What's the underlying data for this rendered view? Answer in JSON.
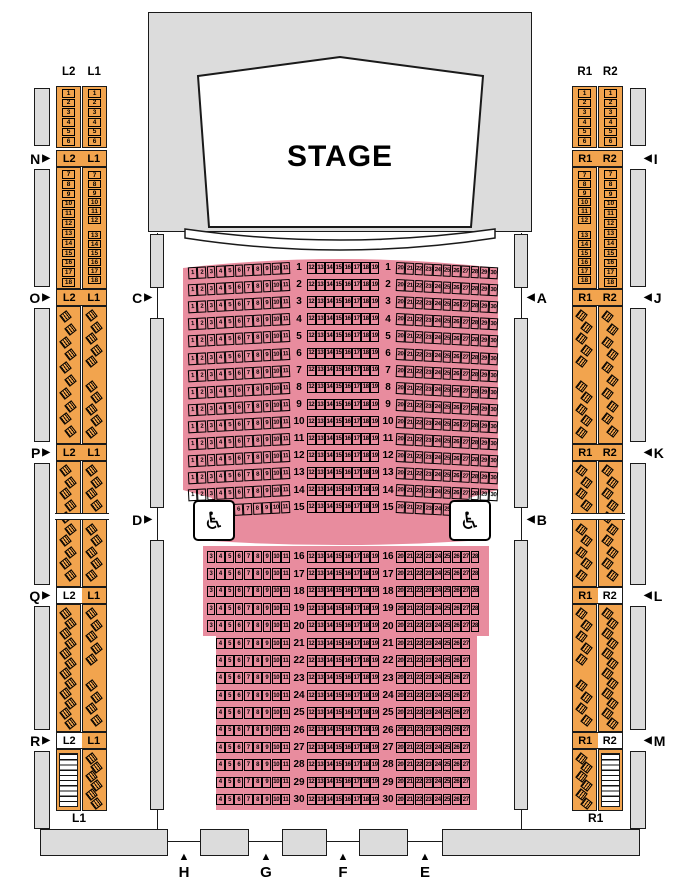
{
  "stage": {
    "label": "STAGE"
  },
  "colors": {
    "box_fill": "#f2a44e",
    "orchestra_fill": "#e88c9e",
    "wall_fill": "#dcdcdc",
    "line": "#1a1a1a",
    "background": "#ffffff"
  },
  "orchestra": {
    "wheelchair_symbol": "♿",
    "rows": [
      {
        "row": 1,
        "left": [
          1,
          11
        ],
        "center": [
          12,
          19
        ],
        "right": [
          20,
          30
        ]
      },
      {
        "row": 2,
        "left": [
          1,
          11
        ],
        "center": [
          12,
          19
        ],
        "right": [
          20,
          30
        ]
      },
      {
        "row": 3,
        "left": [
          1,
          11
        ],
        "center": [
          12,
          19
        ],
        "right": [
          20,
          30
        ]
      },
      {
        "row": 4,
        "left": [
          1,
          11
        ],
        "center": [
          12,
          19
        ],
        "right": [
          20,
          30
        ]
      },
      {
        "row": 5,
        "left": [
          1,
          11
        ],
        "center": [
          12,
          19
        ],
        "right": [
          20,
          30
        ]
      },
      {
        "row": 6,
        "left": [
          1,
          11
        ],
        "center": [
          12,
          19
        ],
        "right": [
          20,
          30
        ]
      },
      {
        "row": 7,
        "left": [
          1,
          11
        ],
        "center": [
          12,
          19
        ],
        "right": [
          20,
          30
        ]
      },
      {
        "row": 8,
        "left": [
          1,
          11
        ],
        "center": [
          12,
          19
        ],
        "right": [
          20,
          30
        ]
      },
      {
        "row": 9,
        "left": [
          1,
          11
        ],
        "center": [
          12,
          19
        ],
        "right": [
          20,
          30
        ]
      },
      {
        "row": 10,
        "left": [
          1,
          11
        ],
        "center": [
          12,
          19
        ],
        "right": [
          20,
          30
        ]
      },
      {
        "row": 11,
        "left": [
          1,
          11
        ],
        "center": [
          12,
          19
        ],
        "right": [
          20,
          30
        ]
      },
      {
        "row": 12,
        "left": [
          1,
          11
        ],
        "center": [
          12,
          19
        ],
        "right": [
          20,
          30
        ]
      },
      {
        "row": 13,
        "left": [
          1,
          11
        ],
        "center": [
          12,
          19
        ],
        "right": [
          20,
          30
        ]
      },
      {
        "row": 14,
        "left": [
          1,
          11
        ],
        "center": [
          12,
          19
        ],
        "right": [
          20,
          30
        ]
      },
      {
        "row": 15,
        "left": [
          6,
          11
        ],
        "center": [
          12,
          19
        ],
        "right": [
          20,
          25
        ]
      },
      {
        "row": 16,
        "left": [
          3,
          11
        ],
        "center": [
          12,
          19
        ],
        "right": [
          20,
          28
        ]
      },
      {
        "row": 17,
        "left": [
          3,
          11
        ],
        "center": [
          12,
          19
        ],
        "right": [
          20,
          28
        ]
      },
      {
        "row": 18,
        "left": [
          3,
          11
        ],
        "center": [
          12,
          19
        ],
        "right": [
          20,
          28
        ]
      },
      {
        "row": 19,
        "left": [
          3,
          11
        ],
        "center": [
          12,
          19
        ],
        "right": [
          20,
          28
        ]
      },
      {
        "row": 20,
        "left": [
          3,
          11
        ],
        "center": [
          12,
          19
        ],
        "right": [
          20,
          28
        ]
      },
      {
        "row": 21,
        "left": [
          4,
          11
        ],
        "center": [
          12,
          19
        ],
        "right": [
          20,
          27
        ]
      },
      {
        "row": 22,
        "left": [
          4,
          11
        ],
        "center": [
          12,
          19
        ],
        "right": [
          20,
          27
        ]
      },
      {
        "row": 23,
        "left": [
          4,
          11
        ],
        "center": [
          12,
          19
        ],
        "right": [
          20,
          27
        ]
      },
      {
        "row": 24,
        "left": [
          4,
          11
        ],
        "center": [
          12,
          19
        ],
        "right": [
          20,
          27
        ]
      },
      {
        "row": 25,
        "left": [
          4,
          11
        ],
        "center": [
          12,
          19
        ],
        "right": [
          20,
          27
        ]
      },
      {
        "row": 26,
        "left": [
          4,
          11
        ],
        "center": [
          12,
          19
        ],
        "right": [
          20,
          27
        ]
      },
      {
        "row": 27,
        "left": [
          4,
          11
        ],
        "center": [
          12,
          19
        ],
        "right": [
          20,
          27
        ]
      },
      {
        "row": 28,
        "left": [
          4,
          11
        ],
        "center": [
          12,
          19
        ],
        "right": [
          20,
          27
        ]
      },
      {
        "row": 29,
        "left": [
          4,
          11
        ],
        "center": [
          12,
          19
        ],
        "right": [
          20,
          27
        ]
      },
      {
        "row": 30,
        "left": [
          4,
          11
        ],
        "center": [
          12,
          19
        ],
        "right": [
          20,
          27
        ]
      }
    ]
  },
  "side_boxes": {
    "left": {
      "column_titles": [
        "L2",
        "L1"
      ],
      "bottom_label": "L1",
      "sections": [
        {
          "marker": null,
          "band_labels": null,
          "cols": [
            {
              "label": "L2",
              "type": "seats",
              "groups": [
                [
                  1,
                  6
                ]
              ]
            },
            {
              "label": "L1",
              "type": "seats",
              "groups": [
                [
                  1,
                  6
                ]
              ]
            }
          ]
        },
        {
          "marker": "N",
          "band_labels": [
            "L2",
            "L1"
          ],
          "cols": [
            {
              "label": "L2",
              "type": "seats",
              "groups": [
                [
                  7,
                  18
                ]
              ]
            },
            {
              "label": "L1",
              "type": "seats",
              "groups": [
                [
                  7,
                  12
                ],
                [
                  13,
                  18
                ]
              ]
            }
          ]
        },
        {
          "marker": "O",
          "band_labels": [
            "L2",
            "L1"
          ],
          "cols": [
            {
              "label": "L2",
              "type": "angled",
              "counts": [
                10
              ]
            },
            {
              "label": "L1",
              "type": "angled",
              "counts": [
                5,
                5
              ]
            }
          ]
        },
        {
          "marker": "P",
          "band_labels": [
            "L2",
            "L1"
          ],
          "cols": [
            {
              "label": "L2",
              "type": "angled",
              "counts": [
                4,
                6
              ]
            },
            {
              "label": "L1",
              "type": "angled",
              "counts": [
                4,
                5
              ]
            }
          ]
        },
        {
          "marker": "Q",
          "band_labels": [
            "L2",
            "L1"
          ],
          "cols": [
            {
              "label": "L2",
              "type": "angled",
              "counts": [
                12
              ]
            },
            {
              "label": "L1",
              "type": "angled",
              "counts": [
                5,
                4
              ]
            }
          ]
        },
        {
          "marker": "R",
          "band_labels": [
            "L2",
            "L1"
          ],
          "cols": [
            {
              "label": "L2",
              "type": "stairs"
            },
            {
              "label": "L1",
              "type": "angled",
              "counts": [
                6
              ]
            }
          ]
        }
      ]
    },
    "right": {
      "column_titles": [
        "R1",
        "R2"
      ],
      "bottom_label": "R1",
      "sections": [
        {
          "marker": null,
          "band_labels": null,
          "cols": [
            {
              "label": "R1",
              "type": "seats",
              "groups": [
                [
                  1,
                  6
                ]
              ]
            },
            {
              "label": "R2",
              "type": "seats",
              "groups": [
                [
                  1,
                  6
                ]
              ]
            }
          ]
        },
        {
          "marker": "I",
          "band_labels": [
            "R1",
            "R2"
          ],
          "cols": [
            {
              "label": "R1",
              "type": "seats",
              "groups": [
                [
                  7,
                  12
                ],
                [
                  13,
                  18
                ]
              ]
            },
            {
              "label": "R2",
              "type": "seats",
              "groups": [
                [
                  7,
                  18
                ]
              ]
            }
          ]
        },
        {
          "marker": "J",
          "band_labels": [
            "R1",
            "R2"
          ],
          "cols": [
            {
              "label": "R1",
              "type": "angled",
              "counts": [
                5,
                5
              ]
            },
            {
              "label": "R2",
              "type": "angled",
              "counts": [
                10
              ]
            }
          ]
        },
        {
          "marker": "K",
          "band_labels": [
            "R1",
            "R2"
          ],
          "cols": [
            {
              "label": "R1",
              "type": "angled",
              "counts": [
                4,
                5
              ]
            },
            {
              "label": "R2",
              "type": "angled",
              "counts": [
                4,
                6
              ]
            }
          ]
        },
        {
          "marker": "L",
          "band_labels": [
            "R1",
            "R2"
          ],
          "cols": [
            {
              "label": "R1",
              "type": "angled",
              "counts": [
                5,
                4
              ]
            },
            {
              "label": "R2",
              "type": "angled",
              "counts": [
                12
              ]
            }
          ]
        },
        {
          "marker": "M",
          "band_labels": [
            "R1",
            "R2"
          ],
          "cols": [
            {
              "label": "R1",
              "type": "angled",
              "counts": [
                6
              ]
            },
            {
              "label": "R2",
              "type": "stairs"
            }
          ]
        }
      ]
    }
  },
  "door_markers": {
    "outer_left": {
      "arrow": "▶",
      "labels": [
        "N",
        "O",
        "P",
        "Q",
        "R"
      ]
    },
    "outer_right": {
      "arrow": "◀",
      "labels": [
        "I",
        "J",
        "K",
        "L",
        "M"
      ]
    },
    "inner_left": {
      "arrow": "▶",
      "labels": [
        "C",
        "D"
      ]
    },
    "inner_right": {
      "arrow": "◀",
      "labels": [
        "A",
        "B"
      ]
    },
    "bottom": {
      "arrow": "▲",
      "labels": [
        "H",
        "G",
        "F",
        "E"
      ]
    }
  }
}
